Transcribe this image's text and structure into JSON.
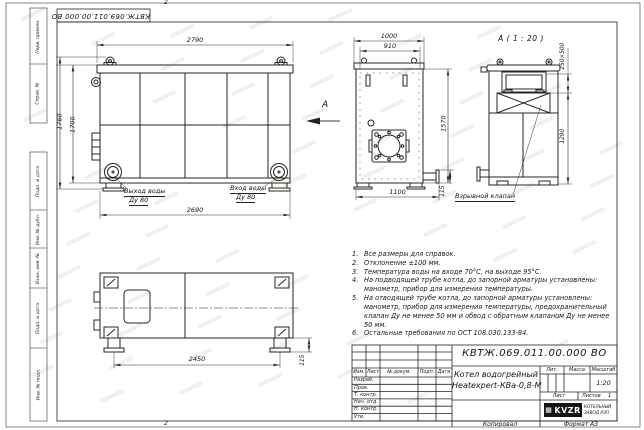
{
  "sheet": {
    "doc_number_top": "КВТЖ.069.011.00.000 ВО",
    "zone_top": "2",
    "zone_bottom": "2"
  },
  "margin": {
    "labels": [
      "Перв. примен.",
      "Справ. №",
      "Подп. и дата",
      "Инв. № дубл.",
      "Взам. инв. №",
      "Подп. и дата",
      "Инв. № подл."
    ]
  },
  "views": {
    "side": {
      "dim_top": "2790",
      "dim_height_outer": "1760",
      "dim_height_inner": "1700",
      "dim_bottom": "2690",
      "outlet_line1": "Выход воды",
      "outlet_line2": "Ду 80",
      "inlet_line1": "Вход воды",
      "inlet_line2": "Ду 80"
    },
    "front": {
      "dim_width_outer": "1000",
      "dim_width_inner": "910",
      "dim_height": "1570",
      "dim_bottom": "1100",
      "dim_foot": "115",
      "view_letter": "А"
    },
    "section_a": {
      "title": "А ( 1 : 20 )",
      "dim_opening": "250×500",
      "dim_height": "1290",
      "valve_label": "Взрывной клапан"
    },
    "plan": {
      "dim_feet": "2450",
      "dim_foot": "115"
    }
  },
  "notes": [
    {
      "num": "1.",
      "text": "Все размеры для справок."
    },
    {
      "num": "2.",
      "text": "Отклонение ±100 мм."
    },
    {
      "num": "3.",
      "text": "Температура воды на входе 70°С, на выходе 95°С."
    },
    {
      "num": "4.",
      "text": "На подводящей трубе котла, до запорной арматуры установлены: манометр, прибор для измерения температуры."
    },
    {
      "num": "5.",
      "text": "На отводящей трубе котла, до запорной арматуры установлены: манометр, прибор для измерения температуры, предохранительный клапан Ду не менее 50 мм и обвод с обратным клапаном Ду не менее 50 мм."
    },
    {
      "num": "6.",
      "text": "Остальные требования по ОСТ 108.030.133-84."
    }
  ],
  "title_block": {
    "doc_number": "КВТЖ.069.011.00.000 ВО",
    "product_name_line1": "Котел водогрейный",
    "product_name_line2": "Heatexpert-КВа-0,8-М",
    "rev_headers": [
      "Изм.",
      "Лист",
      "№ докум.",
      "Подп.",
      "Дата"
    ],
    "staff_rows": [
      "Разраб.",
      "Пров.",
      "Т. контр.",
      "Нач. отд.",
      "Н. контр.",
      "Утв."
    ],
    "lit_label": "Лит.",
    "mass_label": "Масса",
    "scale_label": "Масштаб",
    "scale_value": "1:20",
    "sheet_label": "Лист",
    "sheets_label": "Листов",
    "sheets_value": "1",
    "logo_text": "KVZR",
    "company_line1": "КОТЕЛЬНЫЙ",
    "company_line2": "ЗАВОД РЭП",
    "copied_label": "Копировал",
    "format_label": "Формат А3"
  }
}
